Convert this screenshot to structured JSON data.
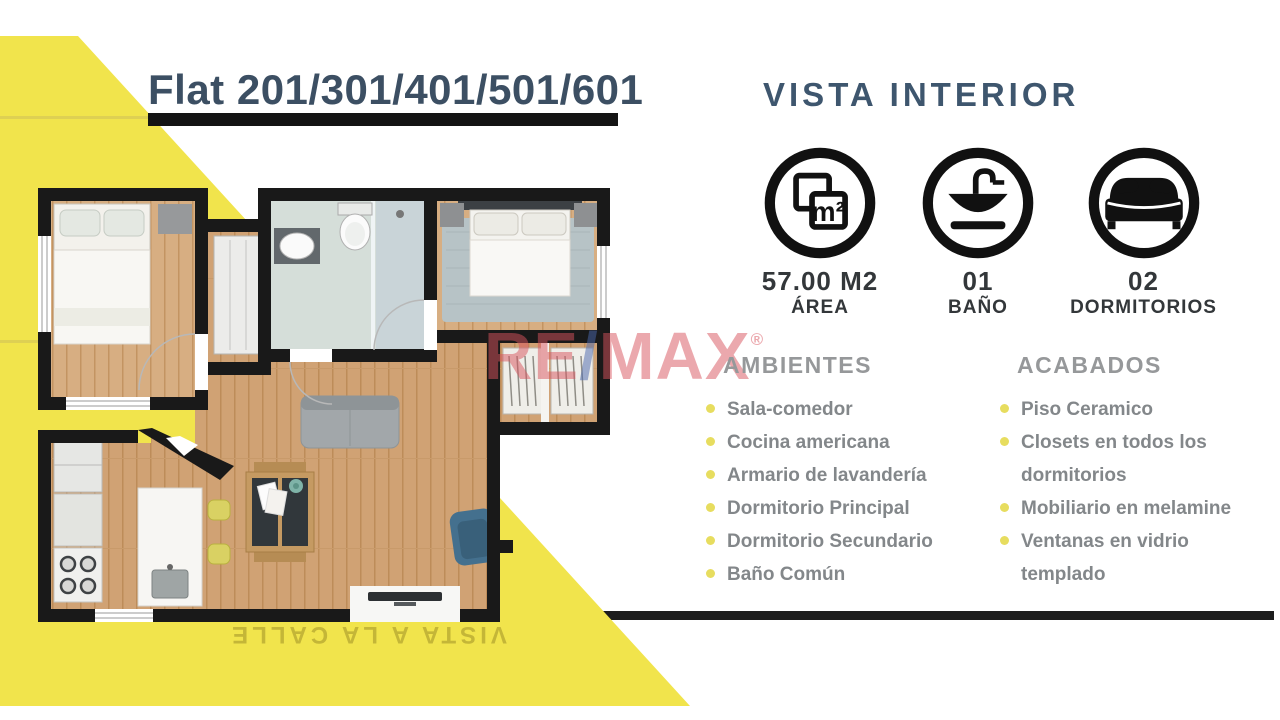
{
  "page": {
    "accent_yellow": "#f1e44c",
    "wall_black": "#191919",
    "title_color": "#3c4f63"
  },
  "header": {
    "title": "Flat 201/301/401/501/601"
  },
  "right": {
    "heading": "VISTA INTERIOR",
    "stats": [
      {
        "icon": "area-m2-icon",
        "icon_glyph": "m²",
        "value": "57.00 M2",
        "label": "ÁREA"
      },
      {
        "icon": "bath-sink-icon",
        "value": "01",
        "label": "BAÑO"
      },
      {
        "icon": "bed-icon",
        "value": "02",
        "label": "DORMITORIOS"
      }
    ],
    "ambientes": {
      "heading": "AMBIENTES",
      "items": [
        "Sala-comedor",
        "Cocina americana",
        "Armario de lavandería",
        "Dormitorio Principal",
        "Dormitorio Secundario",
        "Baño Común"
      ]
    },
    "acabados": {
      "heading": "ACABADOS",
      "items": [
        "Piso Ceramico",
        "Closets en todos los dormitorios",
        "Mobiliario en melamine",
        "Ventanas en vidrio templado"
      ]
    }
  },
  "watermark": {
    "re": "RE",
    "slash": "/",
    "max": "MAX",
    "reg": "®",
    "red": "#d9545e",
    "blue": "#4b69ae"
  },
  "floorplan": {
    "street_label": "VISTA A LA CALLE"
  }
}
